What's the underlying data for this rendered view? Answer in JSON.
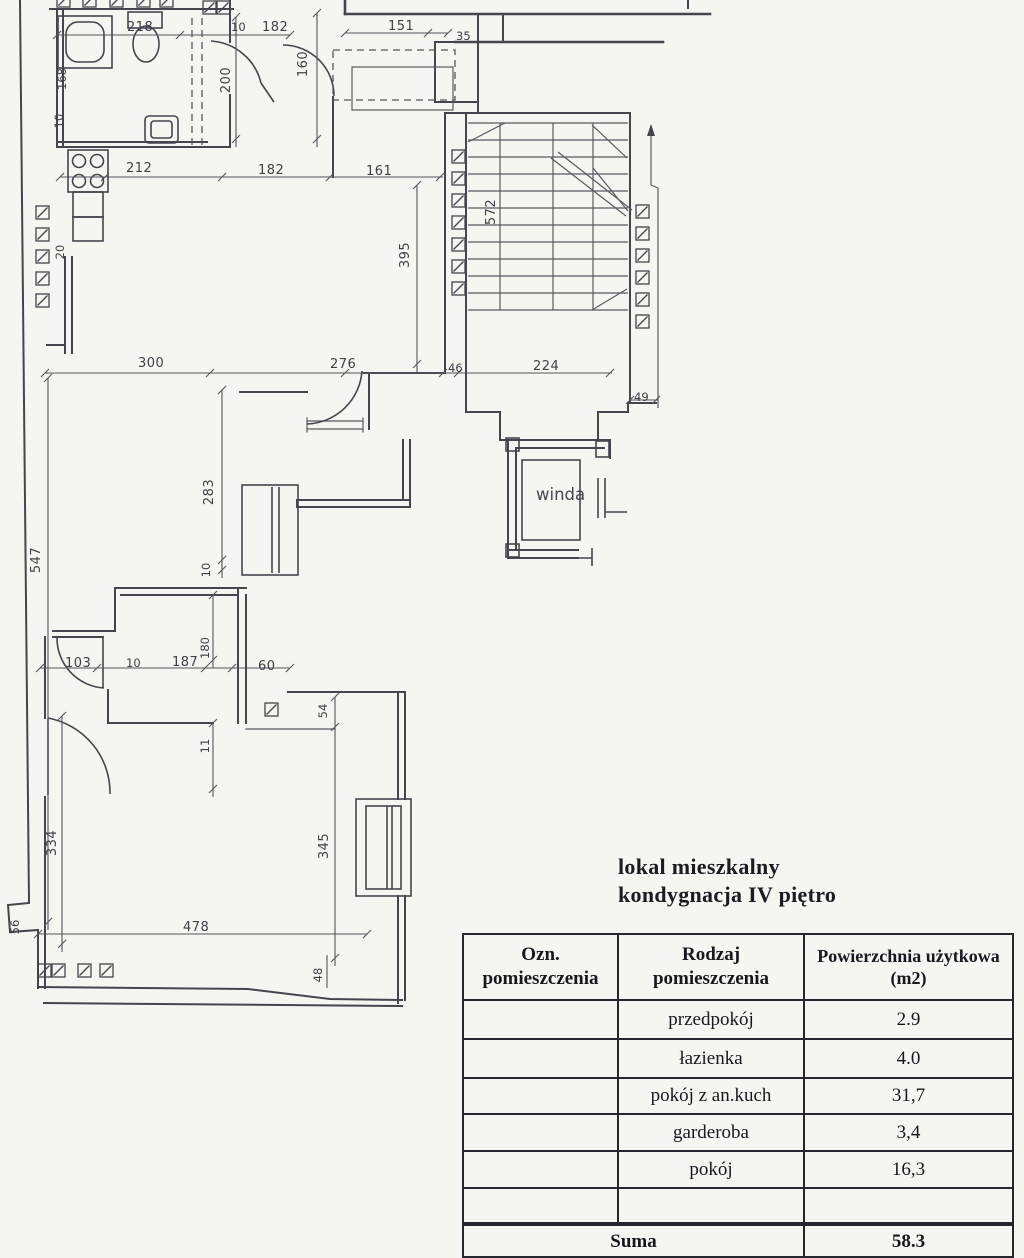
{
  "plan": {
    "labels": {
      "komunikacja_line1": "komunikacja",
      "komunikacja_line2": "(część wspólna)",
      "winda": "winda"
    },
    "dims": [
      "218",
      "10",
      "182",
      "151",
      "35",
      "168",
      "10",
      "200",
      "160",
      "212",
      "182",
      "161",
      "395",
      "572",
      "300",
      "276",
      "46",
      "224",
      "49",
      "547",
      "283",
      "10",
      "103",
      "10",
      "187",
      "180",
      "60",
      "54",
      "11",
      "334",
      "345",
      "478",
      "48",
      "56",
      "20"
    ]
  },
  "title": {
    "line1": "lokal mieszkalny",
    "line2": "kondygnacja IV piętro"
  },
  "table": {
    "col1_l1": "Ozn.",
    "col1_l2": "pomieszczenia",
    "col2_l1": "Rodzaj",
    "col2_l2": "pomieszczenia",
    "col3_l1": "Powierzchnia użytkowa",
    "col3_l2": "(m2)",
    "rows": [
      {
        "name": "przedpokój",
        "area": "2.9"
      },
      {
        "name": "łazienka",
        "area": "4.0"
      },
      {
        "name": "pokój z an.kuch",
        "area": "31,7"
      },
      {
        "name": "garderoba",
        "area": "3,4"
      },
      {
        "name": "pokój",
        "area": "16,3"
      },
      {
        "name": "",
        "area": ""
      }
    ],
    "suma_label": "Suma",
    "suma_value": "58.3"
  }
}
